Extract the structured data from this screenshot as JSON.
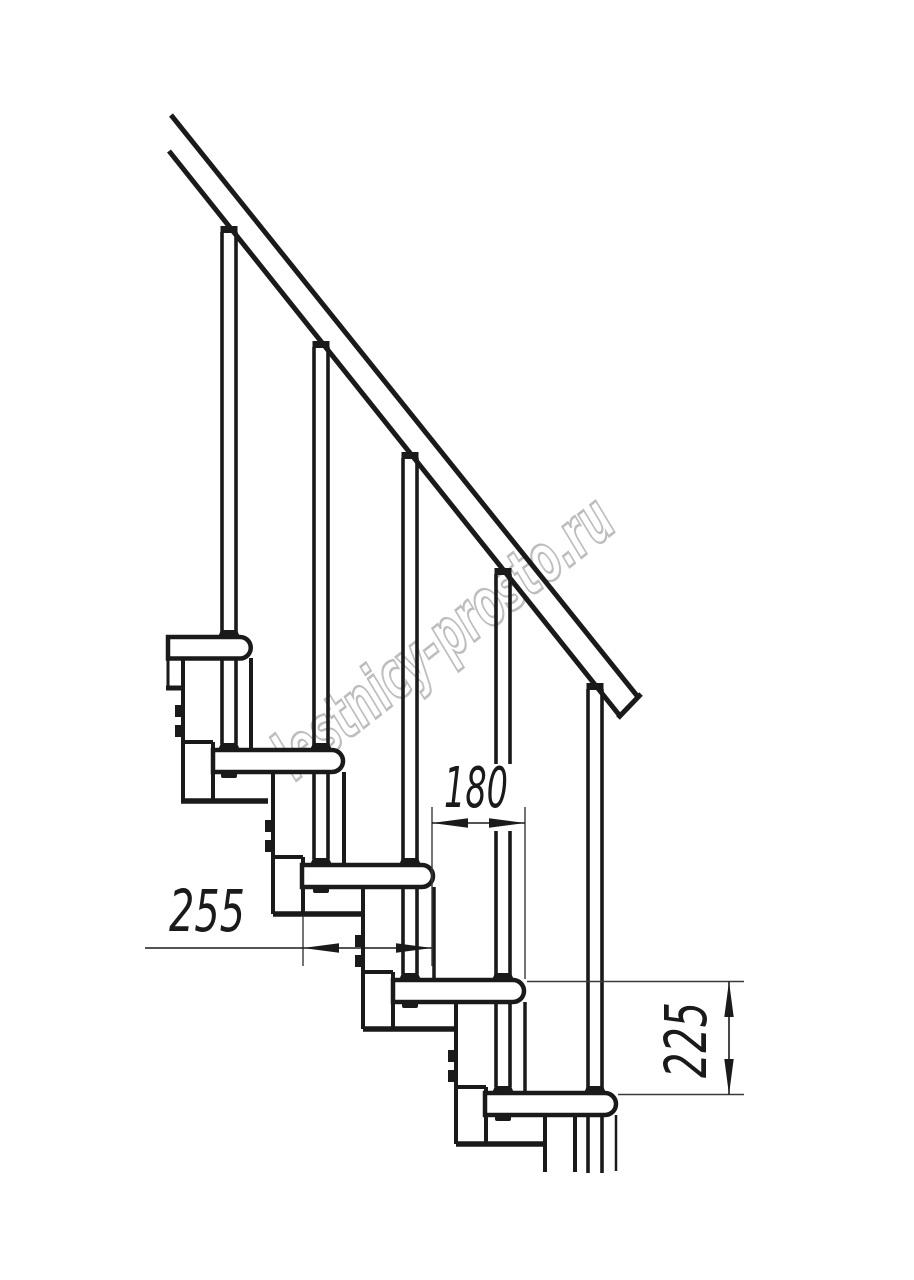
{
  "drawing": {
    "kind": "modular-staircase-side-elevation",
    "watermark": {
      "text": "lestnicy-prosto.ru",
      "color": "#bdbdbd"
    },
    "dimensions": {
      "run": {
        "label": "180"
      },
      "depth": {
        "label": "255"
      },
      "rise": {
        "label": "225"
      }
    },
    "structure": {
      "treads_visible": 5,
      "balusters_visible": 5,
      "handrail": 1
    },
    "colors": {
      "background": "#ffffff",
      "main_line": "#1a1a1a",
      "thin_line": "#3a3a3a"
    }
  }
}
